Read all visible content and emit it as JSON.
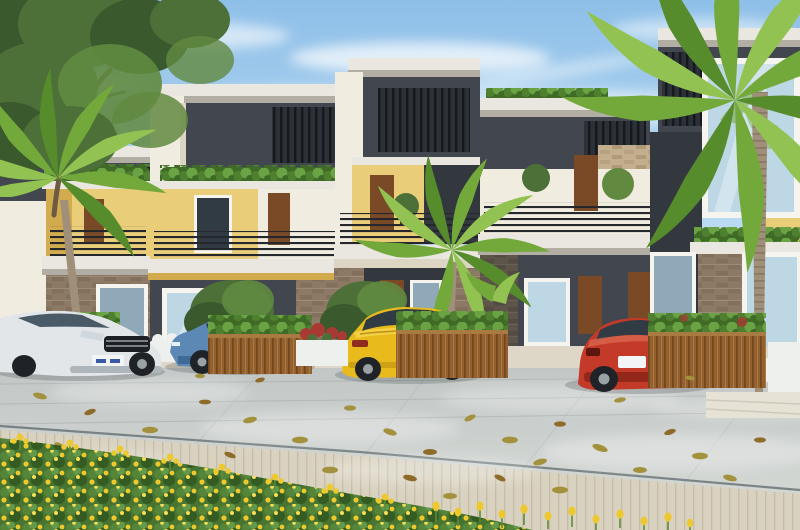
{
  "scene": {
    "type": "architectural-render",
    "description": "Photorealistic rendering of a row of modern two-storey townhouses with flat roofs, white parapets, dark grey slat panels, yellow accent walls, wooden doors, balconies with dark metal railings and rooftop hedges. Palm trees and a large green tree frame the scene. Four cars are parked on a light grey paved plaza scattered with fallen yellow leaves; wooden planter boxes hold shrubs, and a dense yellow flower meadow fills the foreground.",
    "colors": {
      "sky-top": "#8ebfe8",
      "sky-mid": "#b9daf2",
      "sky-low": "#def0fa",
      "cloud": "#ffffff",
      "foliage-dark": "#3a5a2e",
      "foliage-mid": "#4c7038",
      "foliage-light": "#618a40",
      "palm-dark": "#578c2c",
      "palm-mid": "#73a83b",
      "palm-light": "#92c251",
      "palm-trunk": "#a09079",
      "palm-trunk-dark": "#7f705c",
      "tree-trunk": "#6b5a44",
      "parapet": "#eae7e0",
      "fascia": "#b3aea4",
      "wall-dark": "#42474f",
      "wall-dark2": "#33383f",
      "wall-cream": "#f1ece0",
      "cream-shade": "#ddd5c3",
      "wall-yellow": "#eacd78",
      "yellow-shade": "#d3ab4f",
      "door-wood": "#7a4a27",
      "door-dark": "#5a3517",
      "railing": "#24282d",
      "glass": "#bed7e5",
      "glass-dark": "#8fa9b9",
      "frame": "#f6f4ef",
      "window-tint": "#313b44",
      "hedge-dark": "#3f6b26",
      "sidewalk": "#ded7c8",
      "joint": "#5c6769",
      "leaf": "#a3913e",
      "leaf-brown": "#8f6b2a",
      "flower": "#edc92d",
      "stem": "#5d8c3a",
      "car-silver": "#e2e6e9",
      "silver-shade": "#aeb6bc",
      "car-blue": "#5c88b5",
      "blue-dark": "#3f6a95",
      "blue-light": "#88accd",
      "car-yellow": "#e9ba1c",
      "yellow-dark": "#bd9110",
      "yellow-light": "#f5d44e",
      "car-red": "#c43a28",
      "red-dark": "#92271a",
      "red-light": "#dc6a4f",
      "tyre": "#1f2327",
      "hub": "#9aa2a8",
      "white-furn": "#eef0ee",
      "red-flower": "#a83a33",
      "plate": "#f2f4f6"
    },
    "objects": [
      {
        "name": "sky",
        "label": "Clear blue sky with wispy white clouds"
      },
      {
        "name": "left-tree",
        "label": "Large leafy green tree, top left corner"
      },
      {
        "name": "palm-trees",
        "label": "Tropical palms: left, centre and tall right palm"
      },
      {
        "name": "townhouse-row",
        "label": "Row of five modern townhouse modules with balconies, rooftop hedges, yellow and grey facades, stone and brick piers"
      },
      {
        "name": "car-silver",
        "label": "Silver car parked at far left, front view",
        "color": "#e2e6e9"
      },
      {
        "name": "car-blue",
        "label": "Steel-blue sedan parked, side view",
        "color": "#5c88b5"
      },
      {
        "name": "car-yellow",
        "label": "Yellow sedan parked, rear three-quarter view",
        "color": "#e9ba1c"
      },
      {
        "name": "car-red",
        "label": "Red hatchback parked, rear three-quarter view",
        "color": "#c43a28"
      },
      {
        "name": "planters",
        "label": "Slatted wooden planter boxes with green shrubs; small white planter with red flowers"
      },
      {
        "name": "outdoor-furniture",
        "label": "White outdoor sofa and chairs near the entrances"
      },
      {
        "name": "plaza",
        "label": "Light grey paved plaza with diagonal joints, dappled sunlight, dark expansion joint and plank-paved walkway"
      },
      {
        "name": "fallen-leaves",
        "label": "Scattered yellow-olive fallen leaves on the paving"
      },
      {
        "name": "flower-bed",
        "label": "Dense yellow flower meadow across the foreground with sparse tulip-like blooms to the right"
      }
    ]
  }
}
